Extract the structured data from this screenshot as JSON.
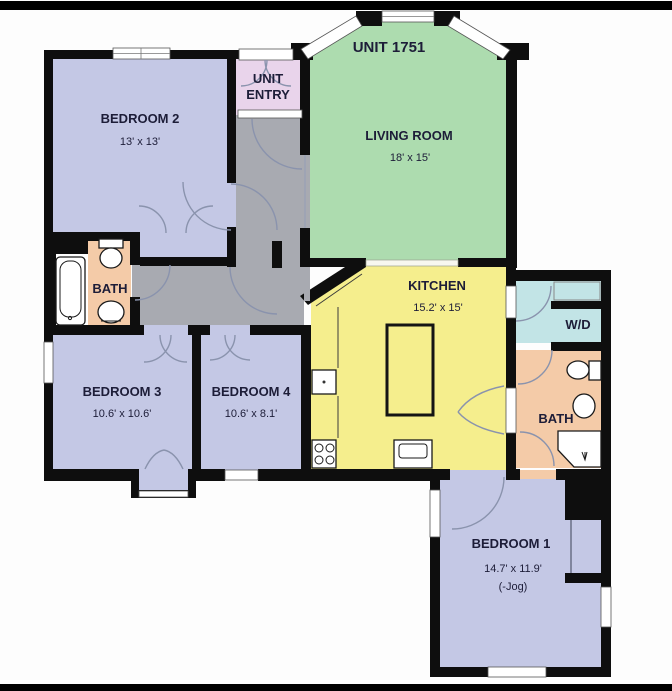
{
  "meta": {
    "unit_title": "UNIT 1751"
  },
  "colors": {
    "background": "#fdfdfd",
    "letterbox": "#000000",
    "wall": "#0e0e0e",
    "text": "#1d1d38",
    "door_arc": "#8a93ad",
    "bedroom": "#c4c8e5",
    "living": "#addcaf",
    "kitchen": "#f5ee8d",
    "bath": "#f4cba8",
    "entry": "#e9d4eb",
    "hall": "#a8aab1",
    "laundry": "#c2e4e6",
    "fixture": "#ffffff"
  },
  "rooms": {
    "living_room": {
      "label": "LIVING ROOM",
      "dims": "18' x 15'",
      "color": "#addcaf"
    },
    "kitchen": {
      "label": "KITCHEN",
      "dims": "15.2' x 15'",
      "color": "#f5ee8d"
    },
    "bedroom1": {
      "label": "BEDROOM 1",
      "dims": "14.7' x 11.9'",
      "note": "(-Jog)",
      "color": "#c4c8e5"
    },
    "bedroom2": {
      "label": "BEDROOM 2",
      "dims": "13' x 13'",
      "color": "#c4c8e5"
    },
    "bedroom3": {
      "label": "BEDROOM 3",
      "dims": "10.6' x 10.6'",
      "color": "#c4c8e5"
    },
    "bedroom4": {
      "label": "BEDROOM 4",
      "dims": "10.6' x 8.1'",
      "color": "#c4c8e5"
    },
    "bath_left": {
      "label": "BATH",
      "color": "#f4cba8"
    },
    "bath_right": {
      "label": "BATH",
      "color": "#f4cba8"
    },
    "unit_entry": {
      "line1": "UNIT",
      "line2": "ENTRY",
      "color": "#e9d4eb"
    },
    "laundry": {
      "label": "W/D",
      "color": "#c2e4e6"
    },
    "hallway": {
      "color": "#a8aab1"
    }
  }
}
